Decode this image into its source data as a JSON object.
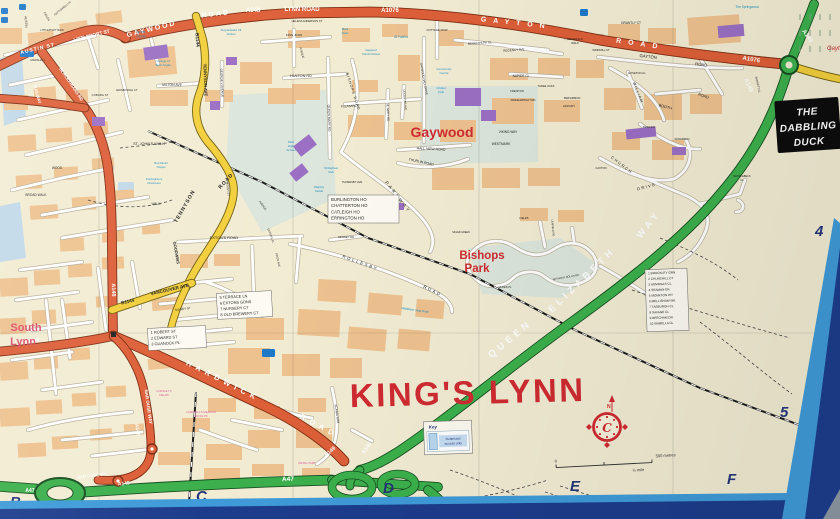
{
  "colors": {
    "paper": "#f2ecd3",
    "block": "#eec28f",
    "roadWhite": "#ffffff",
    "roadCasing": "#b9b09b",
    "orange": "#dd5f38",
    "orangeCasing": "#7d2c12",
    "yellow": "#f2cf3c",
    "yellowCasing": "#6f5e12",
    "green": "#3cb04c",
    "greenCasing": "#174f22",
    "purple": "#9b6fc4",
    "blueIcon": "#1e78c8",
    "parkPale": "#dce6dc",
    "water": "#c2d9e8",
    "black": "#1f1f1f",
    "white": "#ffffff",
    "red": "#cf2b31",
    "rose": "#dd4f6e",
    "blue": "#1e8fc2",
    "pink": "#e25b9c",
    "navy": "#24357a",
    "frameLight": "#3f9bd8",
    "frameNavy": "#1d3c8c",
    "frameGray": "#8d98a2",
    "signBlack": "#0d0d0d"
  },
  "city": "KING'S LYNN",
  "labels": [
    {
      "t": "GAYWOOD",
      "x": 152,
      "y": 31,
      "s": 7,
      "c": "w",
      "b": 1,
      "r": -14,
      "sp": 2
    },
    {
      "t": "ROAD",
      "x": 216,
      "y": 16,
      "s": 7,
      "c": "w",
      "b": 1,
      "r": -7,
      "sp": 2
    },
    {
      "t": "A148",
      "x": 253,
      "y": 12,
      "s": 6,
      "c": "w",
      "b": 1
    },
    {
      "t": "LYNN ROAD",
      "x": 302,
      "y": 11,
      "s": 6,
      "c": "w",
      "b": 1
    },
    {
      "t": "A1076",
      "x": 390,
      "y": 12,
      "s": 6,
      "c": "w",
      "b": 1
    },
    {
      "t": "GAYTON",
      "x": 516,
      "y": 25,
      "s": 7,
      "c": "w",
      "b": 1,
      "r": 6,
      "sp": 7
    },
    {
      "t": "ROAD",
      "x": 640,
      "y": 46,
      "s": 7,
      "c": "w",
      "b": 1,
      "r": 8,
      "sp": 7
    },
    {
      "t": "A1076",
      "x": 751,
      "y": 61,
      "s": 6,
      "c": "w",
      "b": 1,
      "r": 10
    },
    {
      "t": "AUSTIN ST",
      "x": 38,
      "y": 50,
      "s": 5,
      "c": "w",
      "b": 1,
      "r": -13,
      "sp": 1
    },
    {
      "t": "LITTLEPORT ST",
      "x": 92,
      "y": 37,
      "s": 4.8,
      "c": "w",
      "b": 1,
      "r": -14
    },
    {
      "t": "BLACKFRIARS RD",
      "x": 70,
      "y": 85,
      "s": 4.4,
      "c": "w",
      "b": 1,
      "r": 56
    },
    {
      "t": "RAILWAY",
      "x": 36,
      "y": 95,
      "s": 4.2,
      "c": "w",
      "b": 1,
      "r": 74
    },
    {
      "t": "A148",
      "x": 112,
      "y": 290,
      "s": 5.5,
      "c": "w",
      "b": 1,
      "r": 88
    },
    {
      "t": "A149",
      "x": 33,
      "y": 342,
      "s": 5.5,
      "c": "w",
      "b": 1,
      "r": -8
    },
    {
      "t": "HARDWICK",
      "x": 222,
      "y": 383,
      "s": 7.5,
      "c": "w",
      "b": 1,
      "r": 27,
      "sp": 5
    },
    {
      "t": "ROAD",
      "x": 318,
      "y": 428,
      "s": 7.5,
      "c": "w",
      "b": 1,
      "r": 28,
      "sp": 5
    },
    {
      "t": "A149",
      "x": 331,
      "y": 453,
      "s": 5.5,
      "c": "w",
      "b": 1,
      "r": -42
    },
    {
      "t": "A149",
      "x": 368,
      "y": 449,
      "s": 5.5,
      "c": "w",
      "b": 1,
      "r": -55
    },
    {
      "t": "NAR OUSE WAY",
      "x": 147,
      "y": 407,
      "s": 4.5,
      "c": "w",
      "b": 1,
      "r": 82
    },
    {
      "t": "A148",
      "x": 136,
      "y": 430,
      "s": 5,
      "c": "w",
      "b": 1,
      "r": 80
    },
    {
      "t": "NAR OUSE WY",
      "x": 92,
      "y": 477,
      "s": 4.2,
      "c": "w",
      "b": 1,
      "r": -6
    },
    {
      "t": "A148",
      "x": 124,
      "y": 485,
      "s": 5,
      "c": "w",
      "b": 1,
      "r": -6
    },
    {
      "t": "A47",
      "x": 288,
      "y": 481,
      "s": 6.5,
      "c": "w",
      "b": 1,
      "r": -2
    },
    {
      "t": "A47",
      "x": 30,
      "y": 492,
      "s": 5,
      "c": "w",
      "b": 1
    },
    {
      "t": "A149",
      "x": 747,
      "y": 86,
      "s": 6,
      "c": "w",
      "b": 1,
      "r": 64
    },
    {
      "t": "A149",
      "x": 806,
      "y": 37,
      "s": 6,
      "c": "w",
      "b": 1,
      "r": 55
    },
    {
      "t": "QUEEN",
      "x": 512,
      "y": 341,
      "s": 9.5,
      "c": "w",
      "b": 1,
      "r": -40,
      "sp": 4
    },
    {
      "t": "ELIZABETH",
      "x": 584,
      "y": 282,
      "s": 9.5,
      "c": "w",
      "b": 1,
      "r": -44,
      "sp": 4
    },
    {
      "t": "WAY",
      "x": 651,
      "y": 226,
      "s": 9.5,
      "c": "w",
      "b": 1,
      "r": -52,
      "sp": 4
    },
    {
      "t": "B1144",
      "x": 196,
      "y": 40,
      "s": 4.8,
      "b": 1,
      "r": 86
    },
    {
      "t": "TENNYSON AVE",
      "x": 204,
      "y": 80,
      "s": 4.2,
      "b": 1,
      "r": 88
    },
    {
      "t": "TENNYSON",
      "x": 186,
      "y": 207,
      "s": 5.2,
      "b": 1,
      "r": -60,
      "sp": 1
    },
    {
      "t": "ROAD",
      "x": 227,
      "y": 182,
      "s": 5.2,
      "b": 1,
      "r": -48,
      "sp": 1
    },
    {
      "t": "GOODWINS",
      "x": 175,
      "y": 253,
      "s": 4,
      "b": 1,
      "r": 80
    },
    {
      "t": "B1144",
      "x": 128,
      "y": 303,
      "s": 4.6,
      "b": 1,
      "r": -13
    },
    {
      "t": "VANCOUVER AVE",
      "x": 170,
      "y": 291,
      "s": 4.6,
      "b": 1,
      "r": -13
    },
    {
      "t": "AUSTIN",
      "x": 25,
      "y": 22,
      "s": 3.2,
      "r": 85
    },
    {
      "t": "FIELDS",
      "x": 46,
      "y": 17,
      "s": 2.8,
      "r": 60
    },
    {
      "t": "KETTLEWELL LN",
      "x": 63,
      "y": 9,
      "s": 2.6,
      "r": -40
    },
    {
      "t": "LITTLEPORT TERR",
      "x": 52,
      "y": 31,
      "s": 2.6
    },
    {
      "t": "MARSHALL",
      "x": 38,
      "y": 61,
      "s": 2.8
    },
    {
      "t": "COBURG ST",
      "x": 100,
      "y": 96,
      "s": 2.8
    },
    {
      "t": "EDINBURGH CT",
      "x": 127,
      "y": 91,
      "s": 2.8
    },
    {
      "t": "MILTON AVE",
      "x": 172,
      "y": 86,
      "s": 3.4
    },
    {
      "t": "GEORGE V AVENUE",
      "x": 221,
      "y": 83,
      "s": 3,
      "r": 88
    },
    {
      "t": "HULTON RD",
      "x": 301,
      "y": 77,
      "s": 3.8
    },
    {
      "t": "HELENA ANDERSON CT",
      "x": 307,
      "y": 22,
      "s": 2.7
    },
    {
      "t": "KING JOHN",
      "x": 294,
      "y": 36,
      "s": 3
    },
    {
      "t": "AVENUE",
      "x": 301,
      "y": 53,
      "s": 2.8,
      "r": 75
    },
    {
      "t": "COTTAGE ROW",
      "x": 437,
      "y": 31,
      "s": 2.8
    },
    {
      "t": "REGENTS PK CL",
      "x": 480,
      "y": 44,
      "s": 3,
      "r": -4
    },
    {
      "t": "REGENCY AVE",
      "x": 514,
      "y": 51,
      "s": 3,
      "r": -4
    },
    {
      "t": "NAPIER CL",
      "x": 521,
      "y": 77,
      "s": 3.2
    },
    {
      "t": "GENERALS",
      "x": 575,
      "y": 40,
      "s": 2.8
    },
    {
      "t": "WALK",
      "x": 575,
      "y": 44,
      "s": 2.8
    },
    {
      "t": "WINDMILL CT",
      "x": 601,
      "y": 51,
      "s": 2.7
    },
    {
      "t": "GAYTON",
      "x": 648,
      "y": 58,
      "s": 4.2,
      "r": 7
    },
    {
      "t": "ROAD",
      "x": 701,
      "y": 66,
      "s": 4.2,
      "r": 8
    },
    {
      "t": "GRANTLY CT",
      "x": 631,
      "y": 24,
      "s": 3.2
    },
    {
      "t": "HOVETON CL",
      "x": 637,
      "y": 74,
      "s": 2.7
    },
    {
      "t": "WILLIAM",
      "x": 637,
      "y": 93,
      "s": 3.8,
      "r": 68,
      "sp": 1
    },
    {
      "t": "BOOTH",
      "x": 665,
      "y": 108,
      "s": 3.8,
      "r": 15
    },
    {
      "t": "ROAD",
      "x": 703,
      "y": 97,
      "s": 3.8,
      "r": 20
    },
    {
      "t": "PERSIMMON",
      "x": 572,
      "y": 99,
      "s": 2.7
    },
    {
      "t": "HICKORY",
      "x": 569,
      "y": 107,
      "s": 2.7
    },
    {
      "t": "KESWICK",
      "x": 649,
      "y": 128,
      "s": 2.7
    },
    {
      "t": "WINGFIELD",
      "x": 682,
      "y": 140,
      "s": 2.7
    },
    {
      "t": "CAXTON",
      "x": 601,
      "y": 169,
      "s": 2.7
    },
    {
      "t": "CHURCH",
      "x": 621,
      "y": 166,
      "s": 4,
      "r": 38,
      "sp": 1.5
    },
    {
      "t": "DRIVE",
      "x": 647,
      "y": 188,
      "s": 4,
      "r": -15,
      "sp": 1.5
    },
    {
      "t": "VIKING WAY",
      "x": 508,
      "y": 133,
      "s": 3.2
    },
    {
      "t": "WESTMARK",
      "x": 501,
      "y": 145,
      "s": 3.2
    },
    {
      "t": "FREISTON",
      "x": 517,
      "y": 92,
      "s": 2.7
    },
    {
      "t": "WHEELWRIGHT RD",
      "x": 523,
      "y": 101,
      "s": 2.7
    },
    {
      "t": "THREE OAKS",
      "x": 546,
      "y": 87,
      "s": 2.6
    },
    {
      "t": "QUEEN MARY RD",
      "x": 328,
      "y": 118,
      "s": 3.2,
      "r": 88
    },
    {
      "t": "PLEASANCE",
      "x": 350,
      "y": 107,
      "s": 3,
      "r": -4
    },
    {
      "t": "DE GREY RD",
      "x": 387,
      "y": 112,
      "s": 3,
      "r": 88
    },
    {
      "t": "LEICESTER AVE",
      "x": 404,
      "y": 100,
      "s": 2.7,
      "r": 85
    },
    {
      "t": "GAYWOOD HALL DRIVE",
      "x": 423,
      "y": 79,
      "s": 2.9,
      "r": 80
    },
    {
      "t": "BISHOPS ROAD",
      "x": 352,
      "y": 92,
      "s": 3.6,
      "r": 72,
      "sp": 1
    },
    {
      "t": "HALL VIEW ROAD",
      "x": 431,
      "y": 150,
      "s": 3.4,
      "r": 3
    },
    {
      "t": "THURLIN ROAD",
      "x": 421,
      "y": 163,
      "s": 3.4,
      "r": 12
    },
    {
      "t": "PARKWAY",
      "x": 397,
      "y": 198,
      "s": 4.5,
      "r": 52,
      "sp": 2.5
    },
    {
      "t": "THORESBY AVE",
      "x": 352,
      "y": 183,
      "s": 2.7
    },
    {
      "t": "EXTON'S ROAD",
      "x": 224,
      "y": 239,
      "s": 3.8
    },
    {
      "t": "EXTON'S PL",
      "x": 270,
      "y": 236,
      "s": 2.7,
      "r": 70
    },
    {
      "t": "KINGS AVE",
      "x": 277,
      "y": 260,
      "s": 2.7,
      "r": 78
    },
    {
      "t": "MOUNT ST",
      "x": 227,
      "y": 189,
      "s": 2.7,
      "r": 85
    },
    {
      "t": "AVENUE",
      "x": 262,
      "y": 206,
      "s": 2.7,
      "r": 55
    },
    {
      "t": "ROLLESBY",
      "x": 360,
      "y": 264,
      "s": 4.2,
      "r": 20,
      "sp": 2
    },
    {
      "t": "ROAD",
      "x": 432,
      "y": 292,
      "s": 4.2,
      "r": 26,
      "sp": 2
    },
    {
      "t": "DENNEY RD",
      "x": 346,
      "y": 238,
      "s": 2.7
    },
    {
      "t": "ST. JOHN'S WALK",
      "x": 149,
      "y": 145,
      "s": 3.8
    },
    {
      "t": "WALK",
      "x": 156,
      "y": 205,
      "s": 3.2
    },
    {
      "t": "BROAD WALK",
      "x": 36,
      "y": 196,
      "s": 3.2
    },
    {
      "t": "WOOD",
      "x": 57,
      "y": 169,
      "s": 3.2
    },
    {
      "t": "SIDNEY ST",
      "x": 183,
      "y": 310,
      "s": 3,
      "r": -8
    },
    {
      "t": "SCANIA WAY",
      "x": 336,
      "y": 414,
      "s": 3.2,
      "r": 82
    },
    {
      "t": "MAPPLEBECK",
      "x": 742,
      "y": 177,
      "s": 2.6
    },
    {
      "t": "CL",
      "x": 742,
      "y": 181,
      "s": 2.6
    },
    {
      "t": "ANTHONY NOLAN RD",
      "x": 566,
      "y": 278,
      "s": 2.6,
      "r": -10
    },
    {
      "t": "DUKES PL",
      "x": 505,
      "y": 288,
      "s": 2.6
    },
    {
      "t": "LEAFIELD RD",
      "x": 552,
      "y": 228,
      "s": 2.6,
      "r": 85
    },
    {
      "t": "SILVER GREEN",
      "x": 461,
      "y": 233,
      "s": 2.4
    },
    {
      "t": "FIELDS",
      "x": 524,
      "y": 219,
      "s": 2.6
    },
    {
      "t": "BARRETT CL",
      "x": 757,
      "y": 85,
      "s": 2.7,
      "r": 78
    },
    {
      "t": "Gaywood",
      "x": 442,
      "y": 137,
      "s": 14,
      "c": "r",
      "b": 1
    },
    {
      "t": "Bishops",
      "x": 482,
      "y": 259,
      "s": 11.5,
      "c": "r",
      "b": 1
    },
    {
      "t": "Park",
      "x": 477,
      "y": 272,
      "s": 11.5,
      "c": "r",
      "b": 1
    },
    {
      "t": "South",
      "x": 26,
      "y": 331,
      "s": 11,
      "c": "rose",
      "b": 1
    },
    {
      "t": "Lynn",
      "x": 23,
      "y": 345,
      "s": 11,
      "c": "rose",
      "b": 1
    },
    {
      "t": "KING'S LYNN",
      "x": 468,
      "y": 404,
      "s": 33,
      "c": "r",
      "b": 1,
      "sp": 2.5,
      "r": -1.5
    },
    {
      "t": "Gayt",
      "x": 827,
      "y": 50,
      "s": 6,
      "c": "r",
      "i": 1,
      "a": "s"
    },
    {
      "t": "Sports",
      "x": 141,
      "y": 33,
      "s": 3.2,
      "c": "b"
    },
    {
      "t": "Centre",
      "x": 141,
      "y": 37.5,
      "s": 3.2,
      "c": "b"
    },
    {
      "t": "College of",
      "x": 163,
      "y": 62,
      "s": 2.9,
      "c": "b"
    },
    {
      "t": "West Anglia",
      "x": 163,
      "y": 66,
      "s": 2.9,
      "c": "b"
    },
    {
      "t": "King Edward VII",
      "x": 231,
      "y": 31,
      "s": 2.9,
      "c": "b"
    },
    {
      "t": "School",
      "x": 231,
      "y": 35,
      "s": 2.9,
      "c": "b"
    },
    {
      "t": "St Faith's",
      "x": 401,
      "y": 38,
      "s": 3.4,
      "c": "b",
      "i": 1
    },
    {
      "t": "Gaywood",
      "x": 371,
      "y": 51,
      "s": 2.7,
      "c": "b"
    },
    {
      "t": "Church Rooms",
      "x": 371,
      "y": 55,
      "s": 2.7,
      "c": "b"
    },
    {
      "t": "Community",
      "x": 444,
      "y": 70,
      "s": 3,
      "c": "b"
    },
    {
      "t": "Centre",
      "x": 444,
      "y": 74,
      "s": 3,
      "c": "b"
    },
    {
      "t": "Cricket",
      "x": 441,
      "y": 89,
      "s": 3,
      "c": "b"
    },
    {
      "t": "Club",
      "x": 441,
      "y": 93,
      "s": 3,
      "c": "b"
    },
    {
      "t": "Park",
      "x": 291,
      "y": 143,
      "s": 3,
      "c": "b"
    },
    {
      "t": "High",
      "x": 291,
      "y": 147,
      "s": 3,
      "c": "b"
    },
    {
      "t": "School",
      "x": 291,
      "y": 151,
      "s": 3,
      "c": "b"
    },
    {
      "t": "Playing",
      "x": 319,
      "y": 188,
      "s": 3,
      "c": "b",
      "i": 1
    },
    {
      "t": "Fields",
      "x": 319,
      "y": 192,
      "s": 3,
      "c": "b",
      "i": 1
    },
    {
      "t": "St Raphael",
      "x": 331,
      "y": 169,
      "s": 2.8,
      "c": "b"
    },
    {
      "t": "Club",
      "x": 331,
      "y": 173,
      "s": 2.8,
      "c": "b"
    },
    {
      "t": "Red Mount",
      "x": 161,
      "y": 164,
      "s": 2.8,
      "c": "b"
    },
    {
      "t": "Chapel",
      "x": 161,
      "y": 168,
      "s": 2.8,
      "c": "b"
    },
    {
      "t": "Framlingham's",
      "x": 154,
      "y": 180,
      "s": 2.5,
      "c": "b"
    },
    {
      "t": "Almshouses",
      "x": 154,
      "y": 184,
      "s": 2.5,
      "c": "b"
    },
    {
      "t": "The Springwood",
      "x": 747,
      "y": 8,
      "s": 3.2,
      "c": "b"
    },
    {
      "t": "Middleton Stop Drain",
      "x": 415,
      "y": 311,
      "s": 3,
      "c": "b",
      "i": 1,
      "r": 8
    },
    {
      "t": "Black",
      "x": 345,
      "y": 30,
      "s": 2.7,
      "c": "b"
    },
    {
      "t": "Tower",
      "x": 345,
      "y": 34,
      "s": 2.7,
      "c": "b"
    },
    {
      "t": "CAMPBELL'S MEADOW",
      "x": 201,
      "y": 413,
      "s": 2.7,
      "c": "p"
    },
    {
      "t": "RETAIL PK",
      "x": 201,
      "y": 417,
      "s": 2.7,
      "c": "p"
    },
    {
      "t": "RETAIL PARK",
      "x": 307,
      "y": 464,
      "s": 2.7,
      "c": "p"
    },
    {
      "t": "HORSLEY'S",
      "x": 164,
      "y": 392,
      "s": 2.7,
      "c": "p"
    },
    {
      "t": "FIELDS",
      "x": 164,
      "y": 396,
      "s": 2.7,
      "c": "p"
    }
  ],
  "boxes": {
    "key": {
      "title": "Key",
      "lines": [
        "Restricted",
        "access only"
      ]
    },
    "sign": {
      "lines": [
        "THE",
        "DABBLING",
        "DUCK"
      ]
    },
    "list_bishops": [
      "1  BROCKLEY GRN",
      "2  CHURCHILL CT",
      "3  ADMIRALS CL",
      "4  SEAMAN DR",
      "5  MONKTON WY",
      "6  MELLISHAM WK",
      "7  TASBURGH CL",
      "8  SAVAGE CL",
      "9  BEECHAM DR",
      "10  ISABELLA CL"
    ],
    "list_houses": [
      "BURLINGTON HO",
      "CHATTERTON HO",
      "CATLEIGH HO",
      "ERRINGTON HO"
    ],
    "list_terrace": [
      "5  TERRACE LN",
      "6  EXTONS GDNS",
      "7  NURSERY CT",
      "8  OLD BREWERY CT"
    ],
    "list_guanock": [
      "1  ROBERT ST",
      "2  EDWARD ST",
      "3  GUANOCK PL"
    ]
  },
  "scale_bar": {
    "zero": "0",
    "metres": "500 metres",
    "mile": "¼ mile"
  },
  "compass": {
    "letter": "C",
    "north": "N"
  },
  "grid": {
    "columns": [
      "B",
      "C",
      "D",
      "E",
      "F"
    ],
    "rows": [
      "4",
      "5"
    ]
  }
}
